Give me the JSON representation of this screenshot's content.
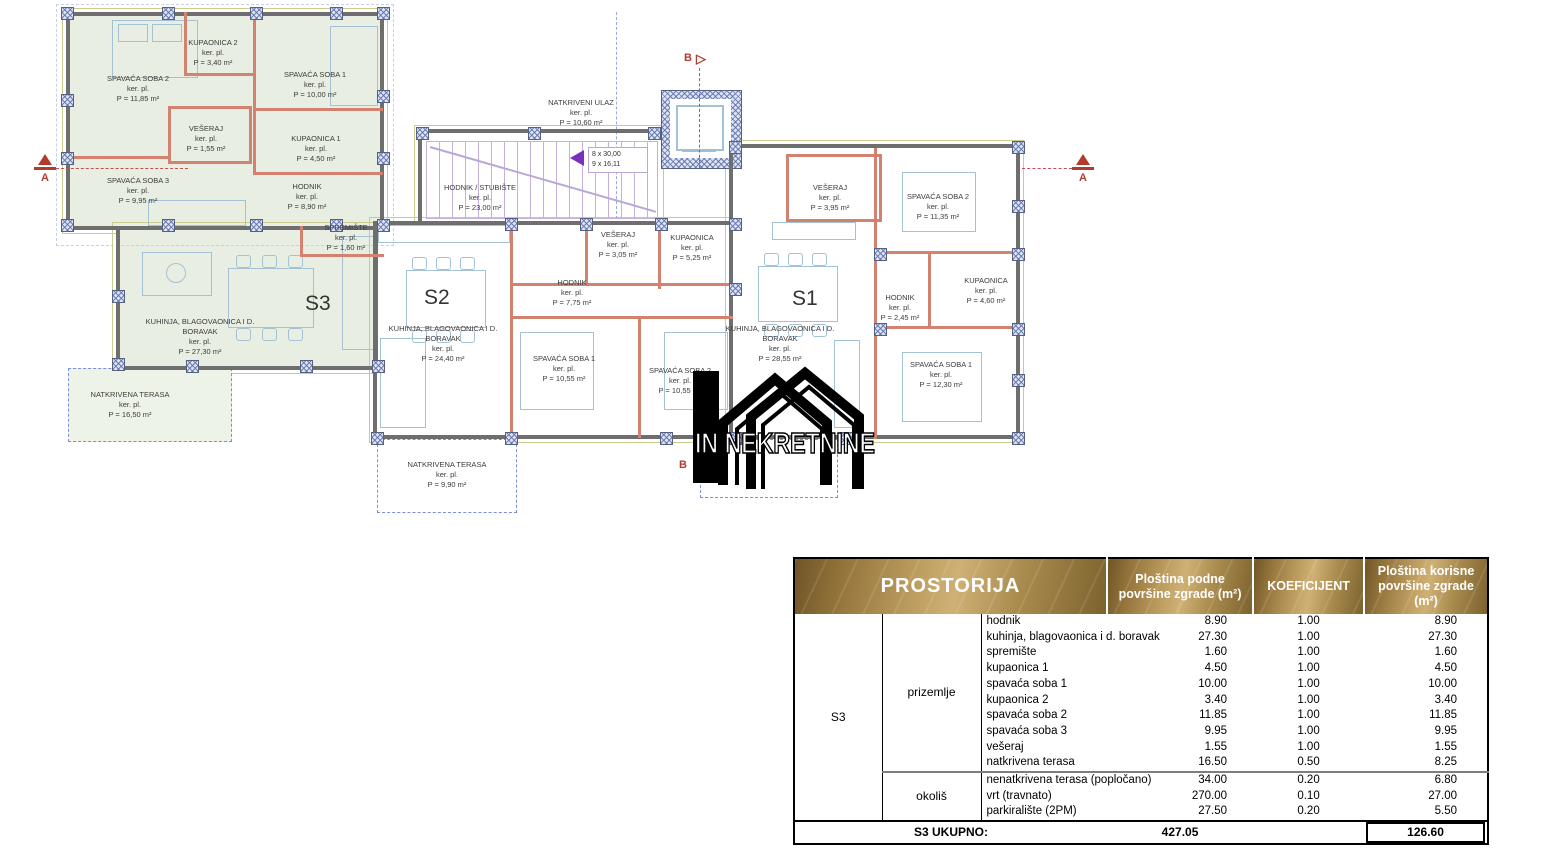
{
  "floor_plan": {
    "ker_pl": "ker. pl.",
    "watermark": "IN NEKRETNINE",
    "markers": {
      "a": "A",
      "b": "B"
    },
    "stairs": {
      "line1": "8 x 30,00",
      "line2": "9 x 16,11"
    },
    "common": {
      "rooms": [
        {
          "n": "NATKRIVENI ULAZ",
          "a": "P = 10,60 m²"
        },
        {
          "n": "HODNIK / STUBIŠTE",
          "a": "P = 23,00 m²"
        }
      ]
    },
    "s3": {
      "label": "S3",
      "rooms": [
        {
          "n": "SPAVAĆA SOBA 2",
          "a": "P = 11,85 m²"
        },
        {
          "n": "KUPAONICA 2",
          "a": "P = 3,40 m²"
        },
        {
          "n": "SPAVAĆA SOBA 1",
          "a": "P = 10,00 m²"
        },
        {
          "n": "VEŠERAJ",
          "a": "P = 1,55 m²"
        },
        {
          "n": "KUPAONICA 1",
          "a": "P = 4,50 m²"
        },
        {
          "n": "SPAVAĆA SOBA 3",
          "a": "P = 9,95 m²"
        },
        {
          "n": "HODNIK",
          "a": "P = 8,90 m²"
        },
        {
          "n": "SPREMIŠTE",
          "a": "P = 1,60 m²"
        },
        {
          "n": "KUHINJA, BLAGOVAONICA I D. BORAVAK",
          "a": "P = 27,30 m²"
        },
        {
          "n": "NATKRIVENA TERASA",
          "a": "P = 16,50 m²"
        }
      ]
    },
    "s2": {
      "label": "S2",
      "rooms": [
        {
          "n": "VEŠERAJ",
          "a": "P = 3,05 m²"
        },
        {
          "n": "KUPAONICA",
          "a": "P = 5,25 m²"
        },
        {
          "n": "HODNIK",
          "a": "P = 7,75 m²"
        },
        {
          "n": "SPAVAĆA SOBA 1",
          "a": "P = 10,55 m²"
        },
        {
          "n": "SPAVAĆA SOBA 2",
          "a": "P = 10,55 m²"
        },
        {
          "n": "KUHINJA, BLAGOVAONICA I D. BORAVAK",
          "a": "P = 24,40 m²"
        },
        {
          "n": "NATKRIVENA TERASA",
          "a": "P = 9,90 m²"
        }
      ]
    },
    "s1": {
      "label": "S1",
      "rooms": [
        {
          "n": "VEŠERAJ",
          "a": "P = 3,95 m²"
        },
        {
          "n": "SPAVAĆA SOBA 2",
          "a": "P = 11,35 m²"
        },
        {
          "n": "HODNIK",
          "a": "P = 2,45 m²"
        },
        {
          "n": "KUPAONICA",
          "a": "P = 4,60 m²"
        },
        {
          "n": "SPAVAĆA SOBA 1",
          "a": "P = 12,30 m²"
        },
        {
          "n": "KUHINJA, BLAGOVAONICA I D. BORAVAK",
          "a": "P = 28,55 m²"
        }
      ]
    }
  },
  "table": {
    "headers": {
      "prostorija": "PROSTORIJA",
      "podne": "Ploština podne površine zgrade (m²)",
      "koef": "KOEFICIJENT",
      "korisne": "Ploština korisne površine zgrade (m²)"
    },
    "unit": "S3",
    "groups": [
      {
        "name": "prizemlje",
        "rows": [
          [
            "hodnik",
            "8.90",
            "1.00",
            "8.90"
          ],
          [
            "kuhinja, blagovaonica i d. boravak",
            "27.30",
            "1.00",
            "27.30"
          ],
          [
            "spremište",
            "1.60",
            "1.00",
            "1.60"
          ],
          [
            "kupaonica 1",
            "4.50",
            "1.00",
            "4.50"
          ],
          [
            "spavaća soba 1",
            "10.00",
            "1.00",
            "10.00"
          ],
          [
            "kupaonica 2",
            "3.40",
            "1.00",
            "3.40"
          ],
          [
            "spavaća soba 2",
            "11.85",
            "1.00",
            "11.85"
          ],
          [
            "spavaća soba 3",
            "9.95",
            "1.00",
            "9.95"
          ],
          [
            "vešeraj",
            "1.55",
            "1.00",
            "1.55"
          ],
          [
            "natkrivena terasa",
            "16.50",
            "0.50",
            "8.25"
          ]
        ]
      },
      {
        "name": "okoliš",
        "rows": [
          [
            "nenatkrivena terasa (popločano)",
            "34.00",
            "0.20",
            "6.80"
          ],
          [
            "vrt (travnato)",
            "270.00",
            "0.10",
            "27.00"
          ],
          [
            "parkiralište (2PM)",
            "27.50",
            "0.20",
            "5.50"
          ]
        ]
      }
    ],
    "footer": {
      "label": "S3 UKUPNO:",
      "podne_total": "427.05",
      "korisne_total": "126.60"
    }
  },
  "colors": {
    "header_gold": "#a8874a",
    "s3_fill": "#e8eee1",
    "marker_red": "#b23b2e",
    "partition_red": "#d2826e",
    "stairs_purple": "#7b2fbe"
  }
}
